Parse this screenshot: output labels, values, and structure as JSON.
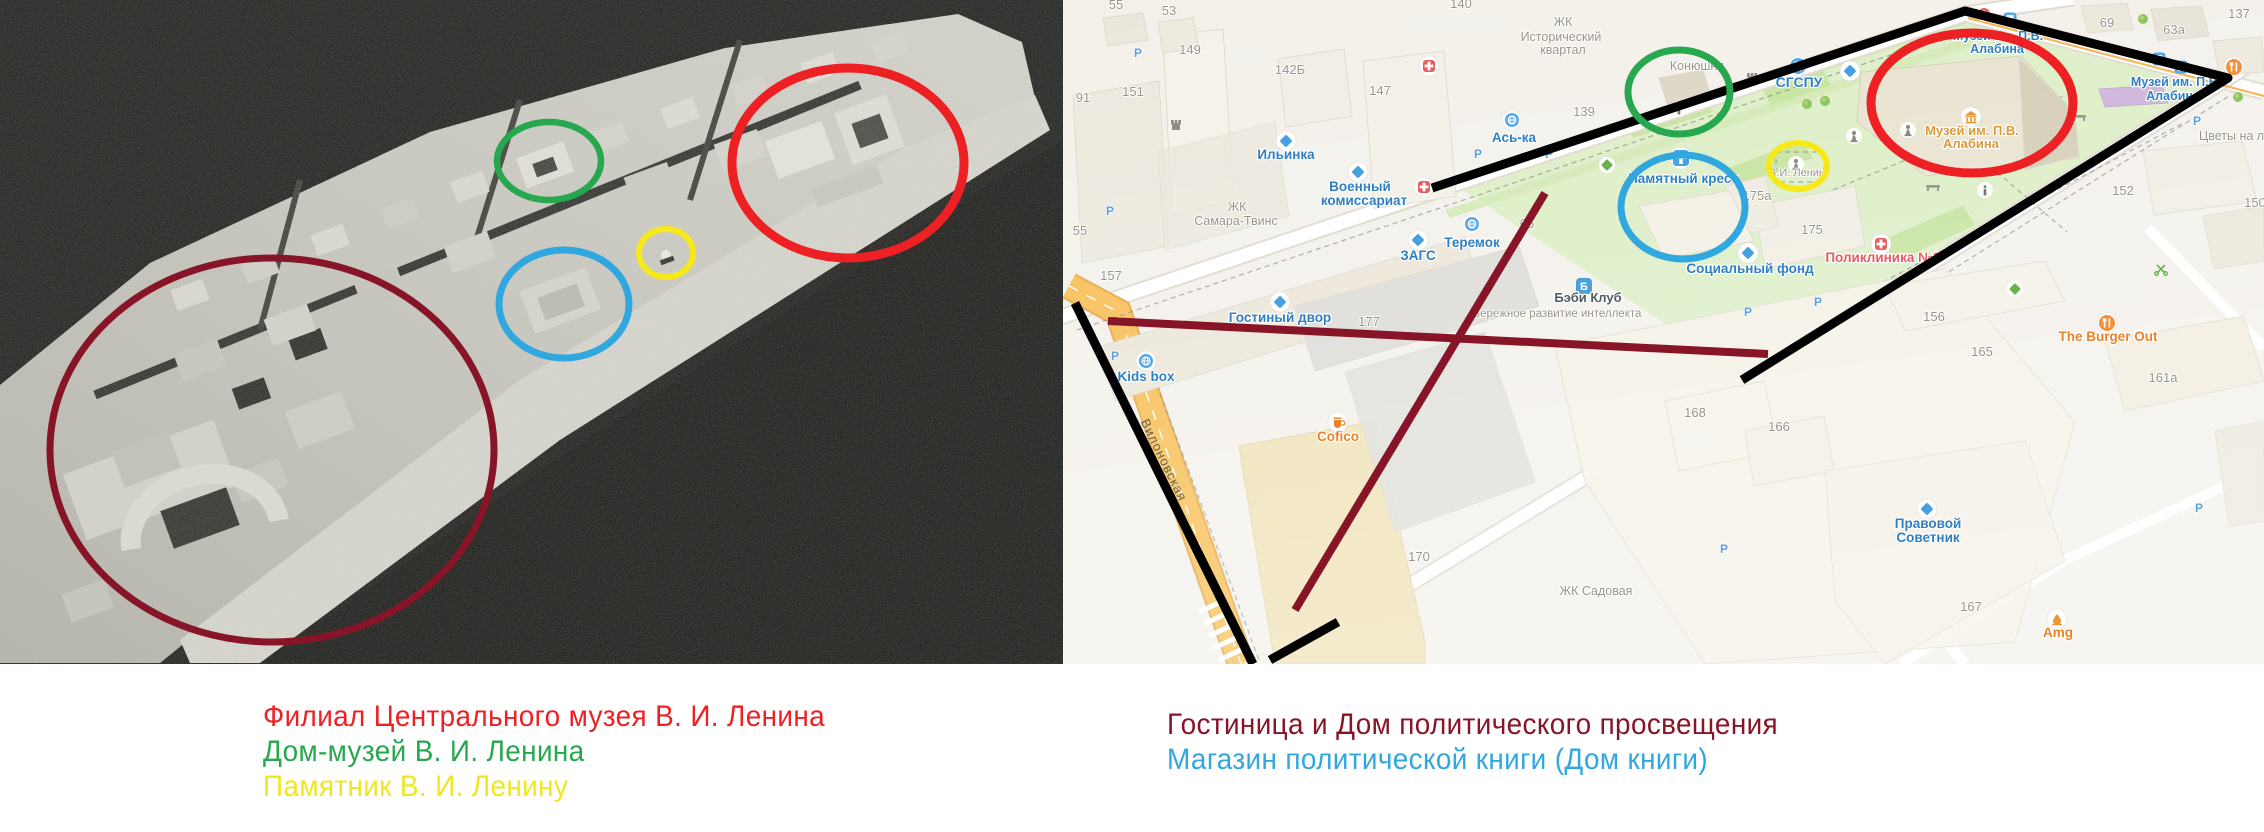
{
  "colors": {
    "red": "#ed2024",
    "green": "#27a74e",
    "yellow": "#f7e919",
    "blue": "#31a7e0",
    "maroon": "#871527",
    "black": "#000000"
  },
  "legend": {
    "left": [
      {
        "label": "Филиал Центрального музея В. И. Ленина",
        "color": "#ed2024"
      },
      {
        "label": "Дом-музей В. И. Ленина",
        "color": "#27a74e"
      },
      {
        "label": "Памятник В. И. Ленину",
        "color": "#f2e71e"
      }
    ],
    "right": [
      {
        "label": "Гостиница и Дом политического просвещения",
        "color": "#871527"
      },
      {
        "label": "Магазин политической книги (Дом книги)",
        "color": "#31a7e0"
      }
    ]
  },
  "map": {
    "icon_letters": {
      "baby_club": "Б"
    },
    "labels": {
      "street": [
        {
          "t": "Вилоновская",
          "x": 97,
          "y": 462,
          "rot": 64
        }
      ],
      "grey": [
        {
          "t": "55",
          "x": 53,
          "y": 9
        },
        {
          "t": "53",
          "x": 106,
          "y": 15
        },
        {
          "t": "149",
          "x": 127,
          "y": 54
        },
        {
          "t": "151",
          "x": 70,
          "y": 96
        },
        {
          "t": "91",
          "x": 20,
          "y": 102
        },
        {
          "t": "142Б",
          "x": 227,
          "y": 74
        },
        {
          "t": "147",
          "x": 317,
          "y": 95
        },
        {
          "t": "55",
          "x": 17,
          "y": 235
        },
        {
          "t": "157",
          "x": 48,
          "y": 280
        },
        {
          "t": "139",
          "x": 521,
          "y": 116
        },
        {
          "t": "140",
          "x": 398,
          "y": 8
        },
        {
          "t": "66",
          "x": 464,
          "y": 228
        },
        {
          "t": "177",
          "x": 306,
          "y": 326
        },
        {
          "t": "170",
          "x": 356,
          "y": 561
        },
        {
          "t": "175а",
          "x": 694,
          "y": 200
        },
        {
          "t": "175",
          "x": 749,
          "y": 234
        },
        {
          "t": "156",
          "x": 871,
          "y": 321
        },
        {
          "t": "165",
          "x": 919,
          "y": 356
        },
        {
          "t": "161а",
          "x": 1100,
          "y": 382
        },
        {
          "t": "166",
          "x": 716,
          "y": 431
        },
        {
          "t": "168",
          "x": 632,
          "y": 417
        },
        {
          "t": "167",
          "x": 908,
          "y": 611
        },
        {
          "t": "152",
          "x": 1060,
          "y": 195
        },
        {
          "t": "150",
          "x": 1192,
          "y": 207
        },
        {
          "t": "137",
          "x": 1176,
          "y": 18
        },
        {
          "t": "69",
          "x": 1044,
          "y": 27
        },
        {
          "t": "63а",
          "x": 1111,
          "y": 34
        },
        {
          "t": "ЖК",
          "x": 174,
          "y": 211,
          "fs": 12.5
        },
        {
          "t": "Самара-Твинс",
          "x": 173,
          "y": 225,
          "fs": 12.5
        },
        {
          "t": "ЖК",
          "x": 500,
          "y": 26,
          "fs": 12.5
        },
        {
          "t": "Исторический",
          "x": 498,
          "y": 41,
          "fs": 12.5
        },
        {
          "t": "квартал",
          "x": 500,
          "y": 54,
          "fs": 12.5
        },
        {
          "t": "Конюшня",
          "x": 634,
          "y": 70,
          "fs": 12.5
        },
        {
          "t": "В.И. Ленин",
          "x": 734,
          "y": 176,
          "fs": 11
        },
        {
          "t": "ЖК Садовая",
          "x": 533,
          "y": 595,
          "fs": 12.5
        },
        {
          "t": "Цветы на лн",
          "x": 1172,
          "y": 140,
          "fs": 12.5
        },
        {
          "t": "Бережное развитие интеллекта",
          "x": 494,
          "y": 317,
          "fs": 11.5
        }
      ],
      "blue": [
        {
          "t": "Ильинка",
          "x": 223,
          "y": 159
        },
        {
          "t": "Военный",
          "x": 297,
          "y": 191
        },
        {
          "t": "комиссариат",
          "x": 301,
          "y": 205
        },
        {
          "t": "ЗАГС",
          "x": 355,
          "y": 260
        },
        {
          "t": "Теремок",
          "x": 409,
          "y": 247
        },
        {
          "t": "Гостиный двор",
          "x": 217,
          "y": 322
        },
        {
          "t": "Ась-ка",
          "x": 451,
          "y": 142
        },
        {
          "t": "СГСПУ",
          "x": 736,
          "y": 87,
          "fs": 14
        },
        {
          "t": "Памятный крест",
          "x": 620,
          "y": 183
        },
        {
          "t": "Социальный фонд",
          "x": 687,
          "y": 273
        },
        {
          "t": "Kids box",
          "x": 83,
          "y": 381
        },
        {
          "t": "Правовой",
          "x": 865,
          "y": 528
        },
        {
          "t": "Советник",
          "x": 865,
          "y": 542
        },
        {
          "t": "Музей им. П.В.",
          "x": 935,
          "y": 40,
          "fs": 12.5
        },
        {
          "t": "Алабина",
          "x": 934,
          "y": 53,
          "fs": 12.5
        },
        {
          "t": "Музей им. П.В.",
          "x": 1113,
          "y": 86,
          "fs": 12.5
        },
        {
          "t": "Алабина",
          "x": 1110,
          "y": 100,
          "fs": 12.5
        }
      ],
      "dark": [
        {
          "t": "Бэби Клуб",
          "x": 525,
          "y": 302
        }
      ],
      "gold": [
        {
          "t": "Музей им. П.В.",
          "x": 909,
          "y": 135
        },
        {
          "t": "Алабина",
          "x": 908,
          "y": 148
        }
      ],
      "orange": [
        {
          "t": "Cofico",
          "x": 275,
          "y": 441
        },
        {
          "t": "The Burger Out",
          "x": 1045,
          "y": 341
        },
        {
          "t": "Amg",
          "x": 995,
          "y": 637
        }
      ],
      "redlbl": [
        {
          "t": "Поликлиника №3",
          "x": 820,
          "y": 262
        }
      ],
      "parking": [
        {
          "t": "P",
          "x": 47,
          "y": 215
        },
        {
          "t": "P",
          "x": 415,
          "y": 158
        },
        {
          "t": "P",
          "x": 486,
          "y": 158
        },
        {
          "t": "P",
          "x": 755,
          "y": 306
        },
        {
          "t": "P",
          "x": 1134,
          "y": 125
        },
        {
          "t": "P",
          "x": 1136,
          "y": 512
        },
        {
          "t": "P",
          "x": 661,
          "y": 553
        },
        {
          "t": "P",
          "x": 685,
          "y": 316
        },
        {
          "t": "P",
          "x": 52,
          "y": 360
        },
        {
          "t": "P",
          "x": 75,
          "y": 57
        }
      ]
    }
  }
}
